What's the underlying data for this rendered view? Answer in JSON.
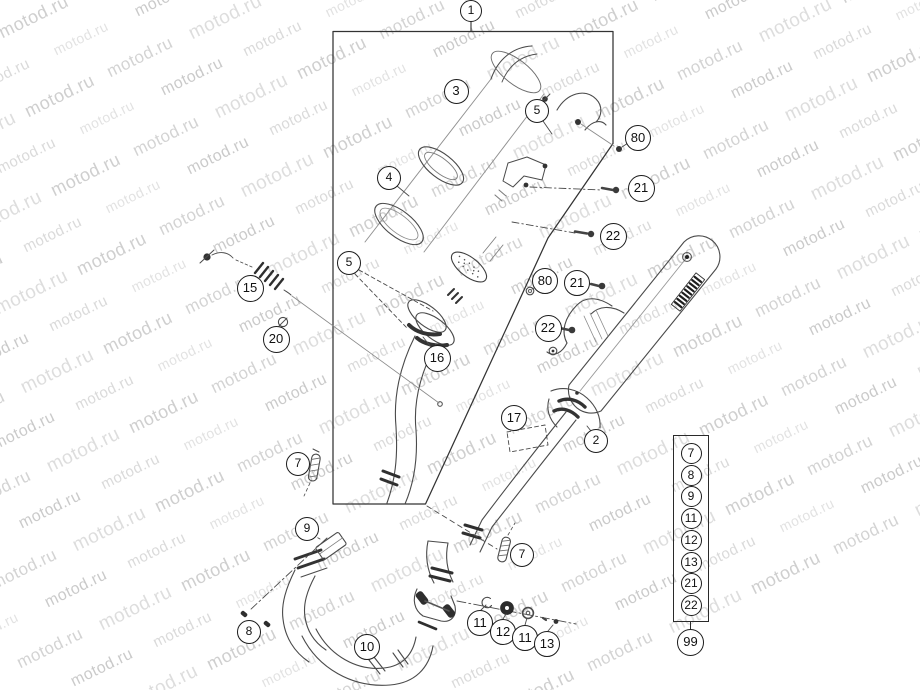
{
  "watermark": {
    "text": "motod.ru"
  },
  "figure": {
    "type": "exploded-parts-diagram",
    "subject": "exhaust-system",
    "main_group_label": "1"
  },
  "callouts": [
    {
      "label": "1",
      "x": 471,
      "y": 11,
      "r": 11
    },
    {
      "label": "3",
      "x": 456,
      "y": 91,
      "r": 12.5
    },
    {
      "label": "5",
      "x": 537,
      "y": 111,
      "r": 12
    },
    {
      "label": "80",
      "x": 638,
      "y": 138,
      "r": 13
    },
    {
      "label": "4",
      "x": 389,
      "y": 178,
      "r": 12
    },
    {
      "label": "21",
      "x": 641,
      "y": 188,
      "r": 13.5
    },
    {
      "label": "22",
      "x": 613,
      "y": 236,
      "r": 13.5
    },
    {
      "label": "5",
      "x": 349,
      "y": 263,
      "r": 12
    },
    {
      "label": "80",
      "x": 545,
      "y": 281,
      "r": 13
    },
    {
      "label": "21",
      "x": 577,
      "y": 283,
      "r": 13
    },
    {
      "label": "15",
      "x": 250,
      "y": 288,
      "r": 13.5
    },
    {
      "label": "22",
      "x": 548,
      "y": 328,
      "r": 13.5
    },
    {
      "label": "20",
      "x": 276,
      "y": 339,
      "r": 13.5
    },
    {
      "label": "16",
      "x": 437,
      "y": 358,
      "r": 13.5
    },
    {
      "label": "17",
      "x": 514,
      "y": 418,
      "r": 13
    },
    {
      "label": "2",
      "x": 596,
      "y": 441,
      "r": 12
    },
    {
      "label": "7",
      "x": 298,
      "y": 464,
      "r": 12
    },
    {
      "label": "9",
      "x": 307,
      "y": 529,
      "r": 12
    },
    {
      "label": "7",
      "x": 522,
      "y": 555,
      "r": 12
    },
    {
      "label": "8",
      "x": 249,
      "y": 632,
      "r": 12
    },
    {
      "label": "10",
      "x": 367,
      "y": 647,
      "r": 13
    },
    {
      "label": "11",
      "x": 480,
      "y": 623,
      "r": 13
    },
    {
      "label": "12",
      "x": 503,
      "y": 632,
      "r": 13
    },
    {
      "label": "11",
      "x": 525,
      "y": 638,
      "r": 13
    },
    {
      "label": "13",
      "x": 547,
      "y": 644,
      "r": 13
    }
  ],
  "legend": {
    "items": [
      "7",
      "8",
      "9",
      "11",
      "12",
      "13",
      "21",
      "22"
    ],
    "footer_label": "99"
  }
}
